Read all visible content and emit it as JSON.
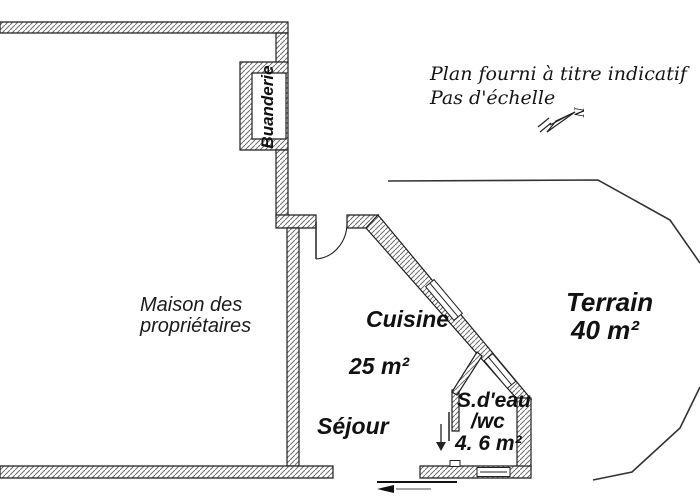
{
  "plan": {
    "note": {
      "line1": "Plan fourni à titre indicatif",
      "line2": "Pas d'échelle"
    },
    "north_label": "N",
    "rooms": {
      "buanderie": {
        "name": "Buanderie"
      },
      "maison": {
        "name_line1": "Maison des",
        "name_line2": "propriétaires"
      },
      "cuisine": {
        "name": "Cuisine",
        "area": "25 m²"
      },
      "sejour": {
        "name": "Séjour"
      },
      "salle_eau": {
        "name_line1": "S.d'eau",
        "name_line2": "/wc",
        "area": "4. 6 m²"
      },
      "terrain": {
        "name": "Terrain",
        "area": "40 m²"
      }
    },
    "colors": {
      "background": "#ffffff",
      "wall_outline": "#1f1f1f",
      "hatch": "#6e6e6e",
      "text": "#111111",
      "boundary": "#333333"
    }
  }
}
